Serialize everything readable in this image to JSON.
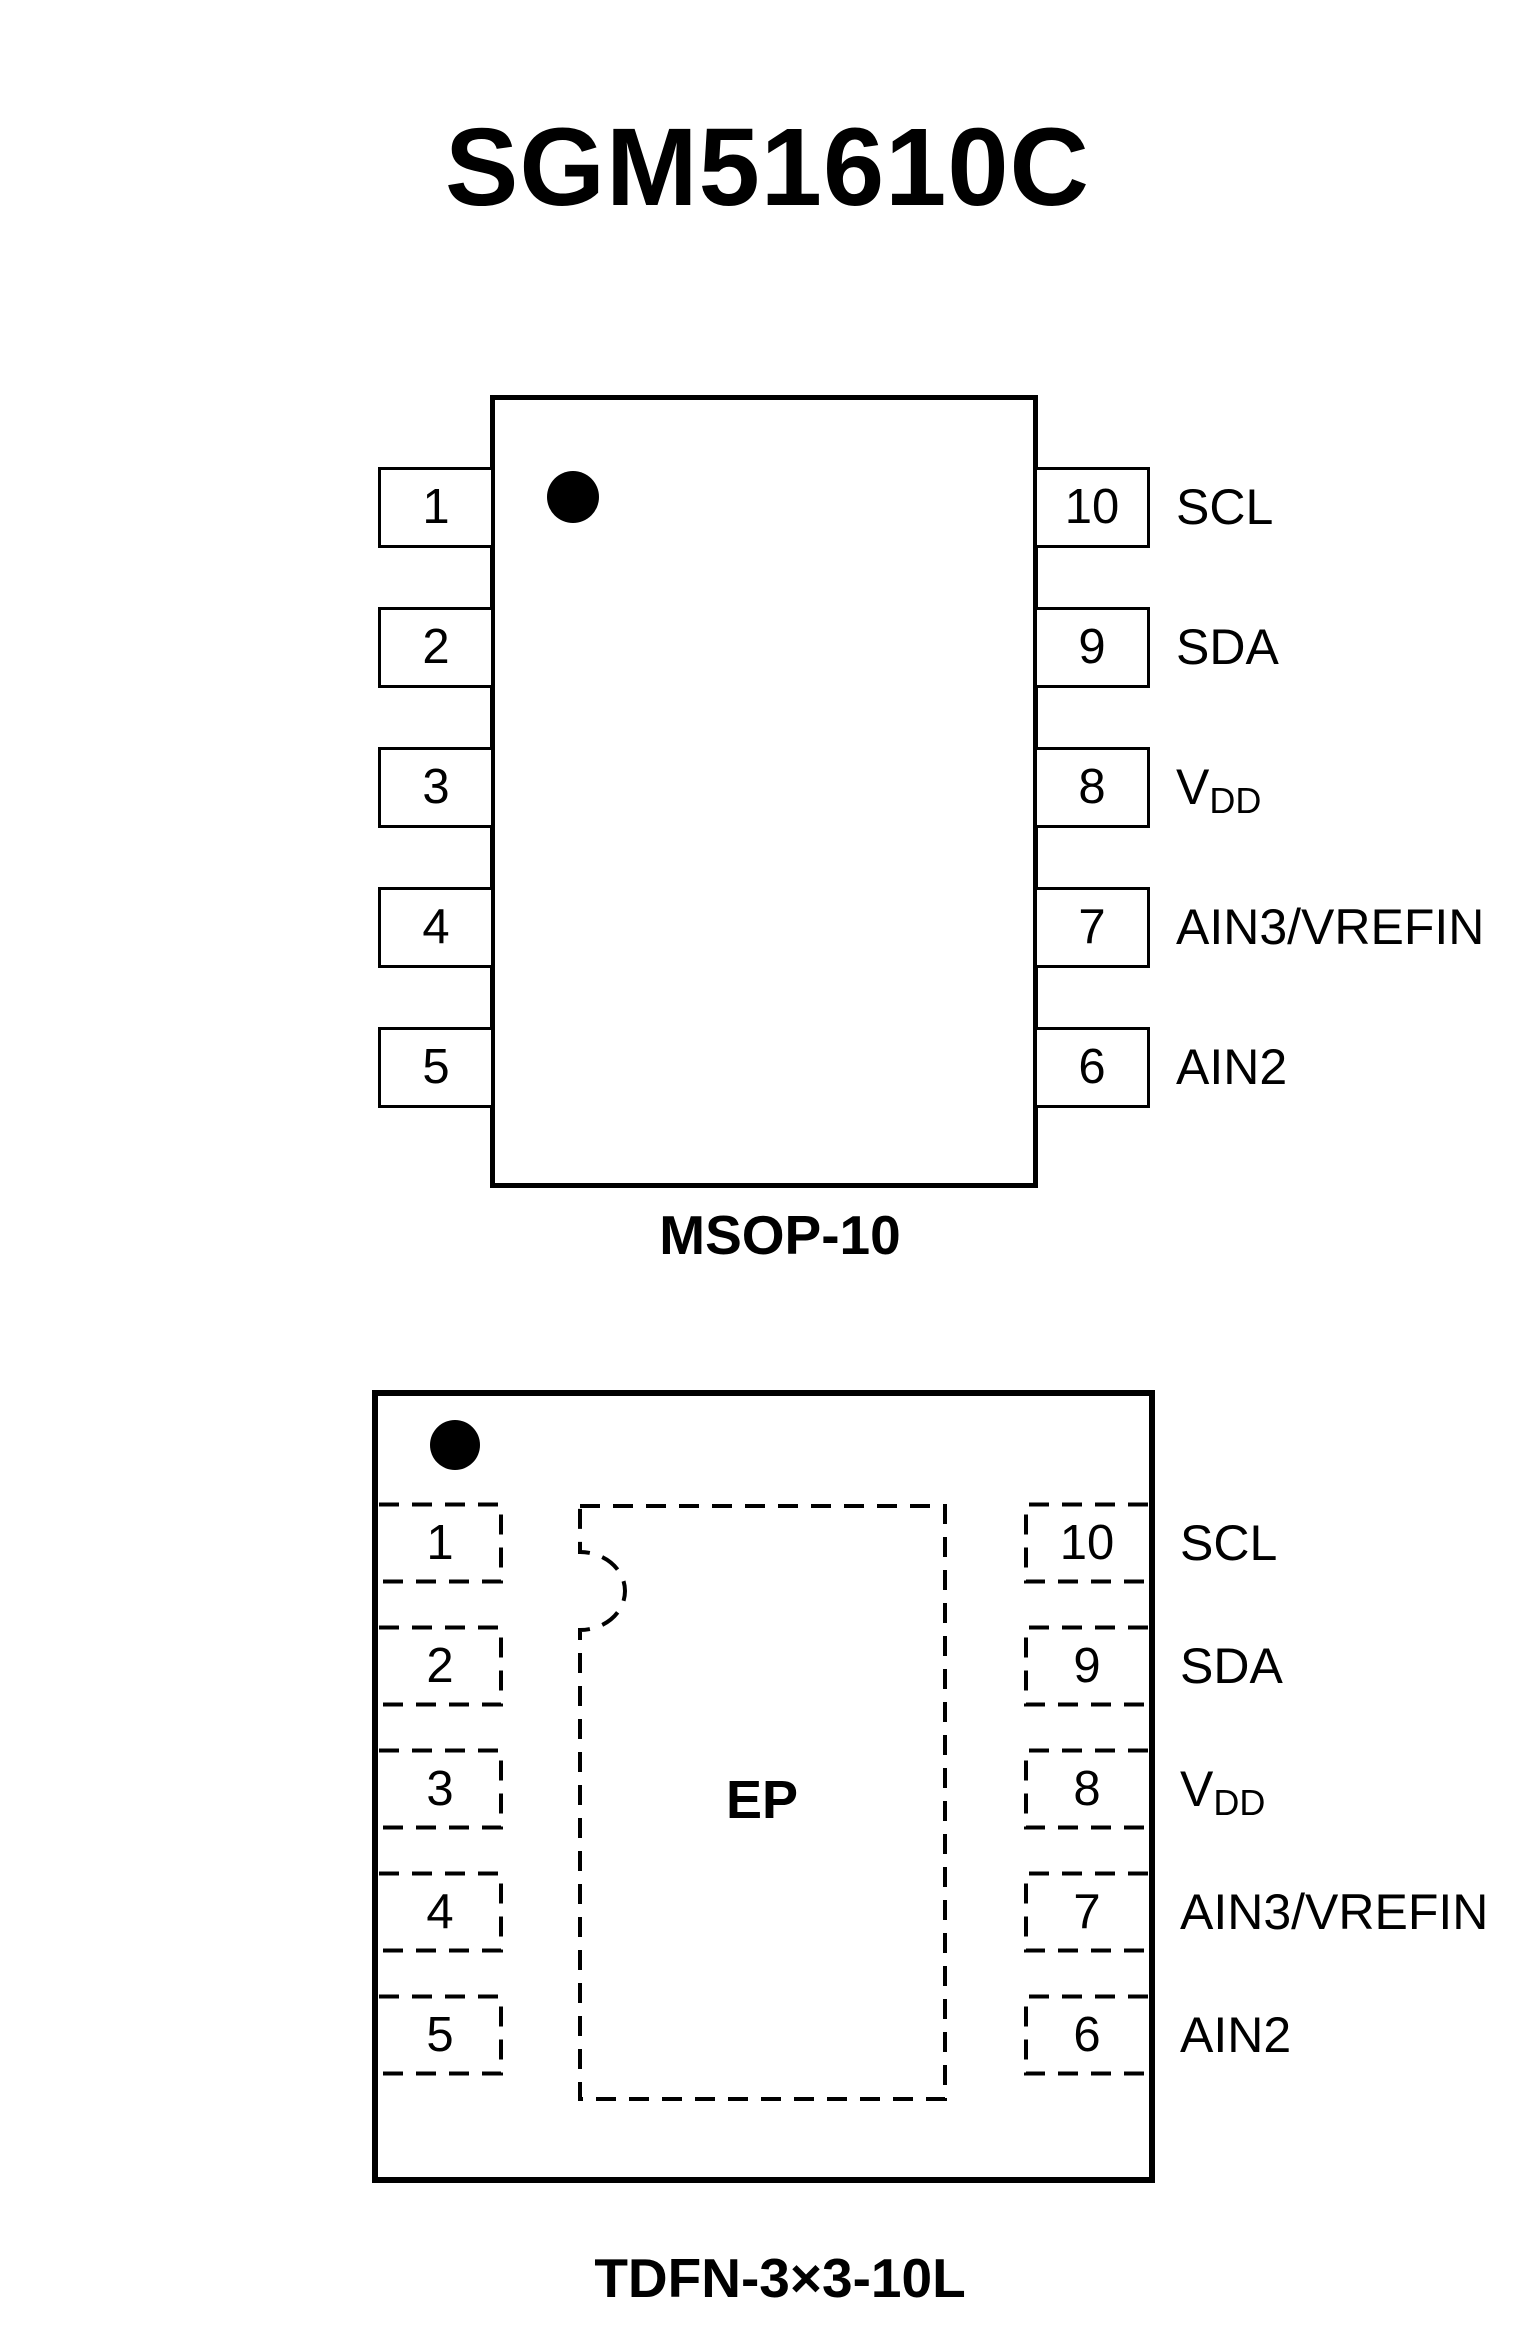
{
  "title": "SGM51610C",
  "colors": {
    "ink": "#000000",
    "background": "#ffffff"
  },
  "packages": [
    {
      "id": "msop10",
      "caption": "MSOP-10",
      "left_pins": [
        {
          "num": "1",
          "label": "ADDR"
        },
        {
          "num": "2",
          "label": "ALERT/RDY"
        },
        {
          "num": "3",
          "label": "GND"
        },
        {
          "num": "4",
          "label": "AIN0"
        },
        {
          "num": "5",
          "label": "AIN1"
        }
      ],
      "right_pins": [
        {
          "num": "10",
          "label": "SCL"
        },
        {
          "num": "9",
          "label": "SDA"
        },
        {
          "num": "8",
          "label": "V",
          "label_sub": "DD"
        },
        {
          "num": "7",
          "label": "AIN3/VREFIN"
        },
        {
          "num": "6",
          "label": "AIN2"
        }
      ]
    },
    {
      "id": "tdfn",
      "caption": "TDFN-3×3-10L",
      "ep_label": "EP",
      "left_pins": [
        {
          "num": "1",
          "label": "ADDR"
        },
        {
          "num": "2",
          "label": "ALERT/RDY"
        },
        {
          "num": "3",
          "label": "GND"
        },
        {
          "num": "4",
          "label": "AIN0"
        },
        {
          "num": "5",
          "label": "AIN1"
        }
      ],
      "right_pins": [
        {
          "num": "10",
          "label": "SCL"
        },
        {
          "num": "9",
          "label": "SDA"
        },
        {
          "num": "8",
          "label": "V",
          "label_sub": "DD"
        },
        {
          "num": "7",
          "label": "AIN3/VREFIN"
        },
        {
          "num": "6",
          "label": "AIN2"
        }
      ]
    }
  ]
}
